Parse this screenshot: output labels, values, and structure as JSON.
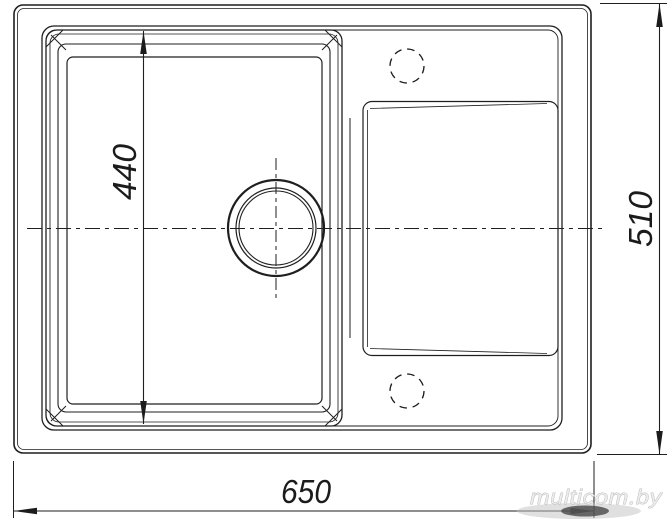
{
  "drawing": {
    "type": "technical-dimension-drawing",
    "subject": "kitchen sink with bowl, drainboard and tap holes, top view"
  },
  "dims": {
    "bowl_width": "440",
    "overall_depth": "510",
    "overall_width": "650"
  },
  "watermark": {
    "text": "multicom.by",
    "color": "#ececec"
  },
  "colors": {
    "line": "#1f1f1f",
    "background": "#ffffff"
  }
}
